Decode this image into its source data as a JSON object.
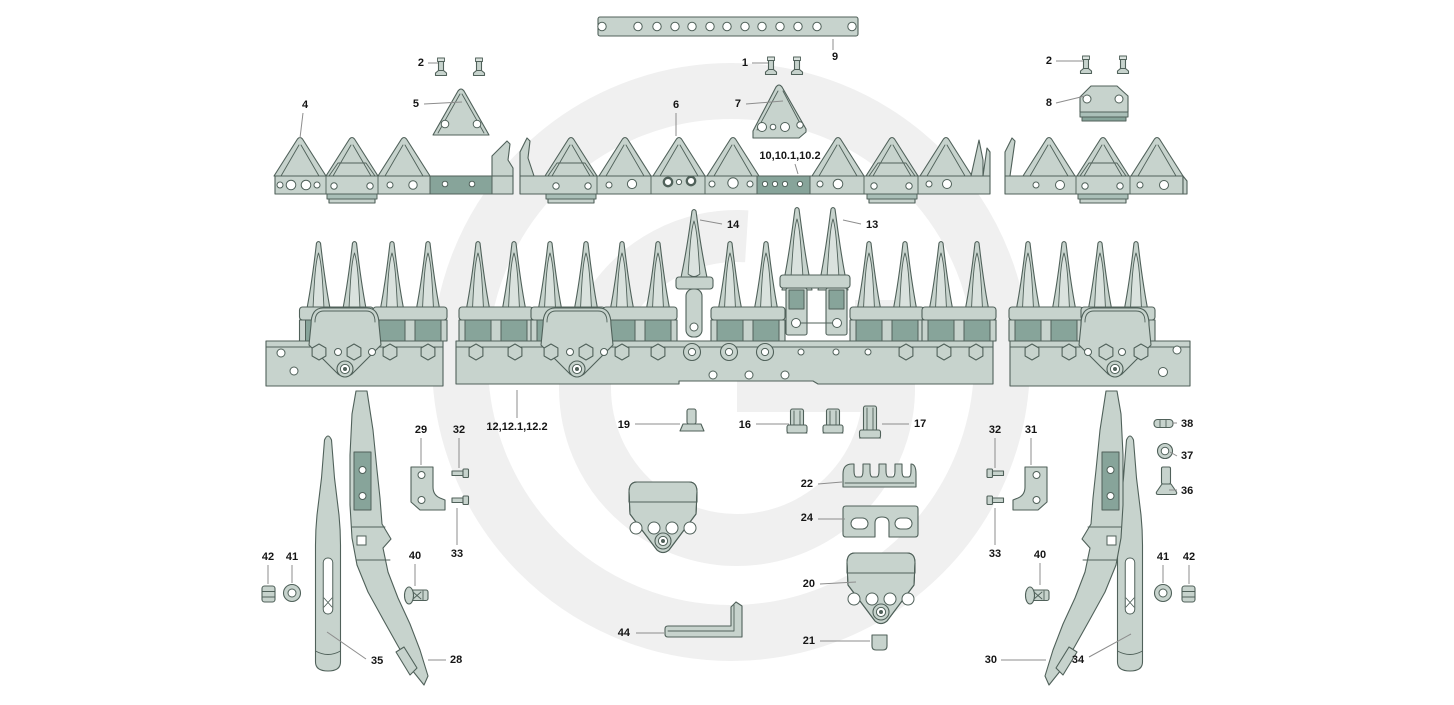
{
  "diagram": {
    "canvas": {
      "width": 1454,
      "height": 705
    },
    "watermark_letter": "G",
    "colors": {
      "background": "#ffffff",
      "part_fill": "#c7d3cd",
      "part_fill_light": "#dae2de",
      "part_fill_mid": "#aabfb8",
      "part_fill_dark": "#87a49a",
      "outline": "#50615a",
      "leader": "#8d8d8d",
      "label_text": "#151515",
      "watermark": "#f0f0f0"
    },
    "part_labels": [
      {
        "id": "1",
        "text": "1",
        "x": 748,
        "y": 66,
        "anchor": "end",
        "leader": [
          [
            752,
            63
          ],
          [
            768,
            63
          ]
        ]
      },
      {
        "id": "2-left",
        "text": "2",
        "x": 424,
        "y": 66,
        "anchor": "end",
        "leader": [
          [
            428,
            63
          ],
          [
            438,
            63
          ]
        ]
      },
      {
        "id": "2-right",
        "text": "2",
        "x": 1052,
        "y": 64,
        "anchor": "end",
        "leader": [
          [
            1056,
            61
          ],
          [
            1083,
            61
          ]
        ]
      },
      {
        "id": "4",
        "text": "4",
        "x": 305,
        "y": 108,
        "anchor": "middle",
        "leader": [
          [
            303,
            113
          ],
          [
            300,
            138
          ]
        ]
      },
      {
        "id": "5",
        "text": "5",
        "x": 419,
        "y": 107,
        "anchor": "end",
        "leader": [
          [
            424,
            104
          ],
          [
            462,
            102
          ]
        ]
      },
      {
        "id": "6",
        "text": "6",
        "x": 676,
        "y": 108,
        "anchor": "middle",
        "leader": [
          [
            676,
            113
          ],
          [
            676,
            136
          ]
        ]
      },
      {
        "id": "7",
        "text": "7",
        "x": 741,
        "y": 107,
        "anchor": "end",
        "leader": [
          [
            746,
            104
          ],
          [
            783,
            101
          ]
        ]
      },
      {
        "id": "8",
        "text": "8",
        "x": 1052,
        "y": 106,
        "anchor": "end",
        "leader": [
          [
            1056,
            103
          ],
          [
            1085,
            96
          ]
        ]
      },
      {
        "id": "9",
        "text": "9",
        "x": 835,
        "y": 60,
        "anchor": "middle",
        "leader": [
          [
            833,
            39
          ],
          [
            833,
            50
          ]
        ]
      },
      {
        "id": "10",
        "text": "10,10.1,10.2",
        "x": 790,
        "y": 159,
        "anchor": "middle",
        "leader": [
          [
            795,
            164
          ],
          [
            798,
            174
          ]
        ]
      },
      {
        "id": "12",
        "text": "12,12.1,12.2",
        "x": 517,
        "y": 430,
        "anchor": "middle",
        "leader": [
          [
            517,
            390
          ],
          [
            517,
            418
          ]
        ]
      },
      {
        "id": "13",
        "text": "13",
        "x": 866,
        "y": 228,
        "anchor": "start",
        "leader": [
          [
            843,
            220
          ],
          [
            861,
            224
          ]
        ]
      },
      {
        "id": "14",
        "text": "14",
        "x": 727,
        "y": 228,
        "anchor": "start",
        "leader": [
          [
            700,
            220
          ],
          [
            722,
            224
          ]
        ]
      },
      {
        "id": "16",
        "text": "16",
        "x": 751,
        "y": 428,
        "anchor": "end",
        "leader": [
          [
            756,
            424
          ],
          [
            789,
            424
          ]
        ]
      },
      {
        "id": "17",
        "text": "17",
        "x": 914,
        "y": 427,
        "anchor": "start",
        "leader": [
          [
            882,
            424
          ],
          [
            909,
            424
          ]
        ]
      },
      {
        "id": "19",
        "text": "19",
        "x": 630,
        "y": 428,
        "anchor": "end",
        "leader": [
          [
            635,
            424
          ],
          [
            680,
            424
          ]
        ]
      },
      {
        "id": "20",
        "text": "20",
        "x": 815,
        "y": 587,
        "anchor": "end",
        "leader": [
          [
            820,
            584
          ],
          [
            856,
            582
          ]
        ]
      },
      {
        "id": "21",
        "text": "21",
        "x": 815,
        "y": 644,
        "anchor": "end",
        "leader": [
          [
            820,
            641
          ],
          [
            870,
            641
          ]
        ]
      },
      {
        "id": "22",
        "text": "22",
        "x": 813,
        "y": 487,
        "anchor": "end",
        "leader": [
          [
            818,
            484
          ],
          [
            842,
            482
          ]
        ]
      },
      {
        "id": "24",
        "text": "24",
        "x": 813,
        "y": 521,
        "anchor": "end",
        "leader": [
          [
            818,
            519
          ],
          [
            845,
            519
          ]
        ]
      },
      {
        "id": "28",
        "text": "28",
        "x": 450,
        "y": 663,
        "anchor": "start",
        "leader": [
          [
            428,
            660
          ],
          [
            446,
            660
          ]
        ]
      },
      {
        "id": "29",
        "text": "29",
        "x": 421,
        "y": 433,
        "anchor": "middle",
        "leader": [
          [
            421,
            438
          ],
          [
            421,
            465
          ]
        ]
      },
      {
        "id": "30",
        "text": "30",
        "x": 997,
        "y": 663,
        "anchor": "end",
        "leader": [
          [
            1001,
            660
          ],
          [
            1046,
            660
          ]
        ]
      },
      {
        "id": "31",
        "text": "31",
        "x": 1031,
        "y": 433,
        "anchor": "middle",
        "leader": [
          [
            1031,
            438
          ],
          [
            1031,
            465
          ]
        ]
      },
      {
        "id": "32-left",
        "text": "32",
        "x": 459,
        "y": 433,
        "anchor": "middle",
        "leader": [
          [
            459,
            438
          ],
          [
            459,
            468
          ]
        ]
      },
      {
        "id": "32-right",
        "text": "32",
        "x": 995,
        "y": 433,
        "anchor": "middle",
        "leader": [
          [
            995,
            438
          ],
          [
            995,
            468
          ]
        ]
      },
      {
        "id": "33-left",
        "text": "33",
        "x": 457,
        "y": 557,
        "anchor": "middle",
        "leader": [
          [
            457,
            508
          ],
          [
            457,
            545
          ]
        ]
      },
      {
        "id": "33-right",
        "text": "33",
        "x": 995,
        "y": 557,
        "anchor": "middle",
        "leader": [
          [
            995,
            508
          ],
          [
            995,
            545
          ]
        ]
      },
      {
        "id": "34",
        "text": "34",
        "x": 1078,
        "y": 663,
        "anchor": "middle",
        "leader": [
          [
            1089,
            657
          ],
          [
            1131,
            634
          ]
        ]
      },
      {
        "id": "35",
        "text": "35",
        "x": 371,
        "y": 664,
        "anchor": "start",
        "leader": [
          [
            327,
            632
          ],
          [
            366,
            659
          ]
        ]
      },
      {
        "id": "36",
        "text": "36",
        "x": 1181,
        "y": 494,
        "anchor": "start",
        "leader": [
          [
            1169,
            490
          ],
          [
            1177,
            490
          ]
        ]
      },
      {
        "id": "37",
        "text": "37",
        "x": 1181,
        "y": 459,
        "anchor": "start",
        "leader": [
          [
            1170,
            452
          ],
          [
            1177,
            456
          ]
        ]
      },
      {
        "id": "38",
        "text": "38",
        "x": 1181,
        "y": 427,
        "anchor": "start",
        "leader": [
          [
            1172,
            423
          ],
          [
            1177,
            423
          ]
        ]
      },
      {
        "id": "40-left",
        "text": "40",
        "x": 415,
        "y": 559,
        "anchor": "middle",
        "leader": [
          [
            415,
            564
          ],
          [
            415,
            586
          ]
        ]
      },
      {
        "id": "40-right",
        "text": "40",
        "x": 1040,
        "y": 558,
        "anchor": "middle",
        "leader": [
          [
            1040,
            563
          ],
          [
            1040,
            585
          ]
        ]
      },
      {
        "id": "41-left",
        "text": "41",
        "x": 292,
        "y": 560,
        "anchor": "middle",
        "leader": [
          [
            292,
            565
          ],
          [
            292,
            583
          ]
        ]
      },
      {
        "id": "41-right",
        "text": "41",
        "x": 1163,
        "y": 560,
        "anchor": "middle",
        "leader": [
          [
            1163,
            565
          ],
          [
            1163,
            583
          ]
        ]
      },
      {
        "id": "42-left",
        "text": "42",
        "x": 268,
        "y": 560,
        "anchor": "middle",
        "leader": [
          [
            268,
            565
          ],
          [
            268,
            584
          ]
        ]
      },
      {
        "id": "42-right",
        "text": "42",
        "x": 1189,
        "y": 560,
        "anchor": "middle",
        "leader": [
          [
            1189,
            565
          ],
          [
            1189,
            584
          ]
        ]
      },
      {
        "id": "44",
        "text": "44",
        "x": 630,
        "y": 636,
        "anchor": "end",
        "leader": [
          [
            636,
            633
          ],
          [
            664,
            633
          ]
        ]
      }
    ]
  }
}
